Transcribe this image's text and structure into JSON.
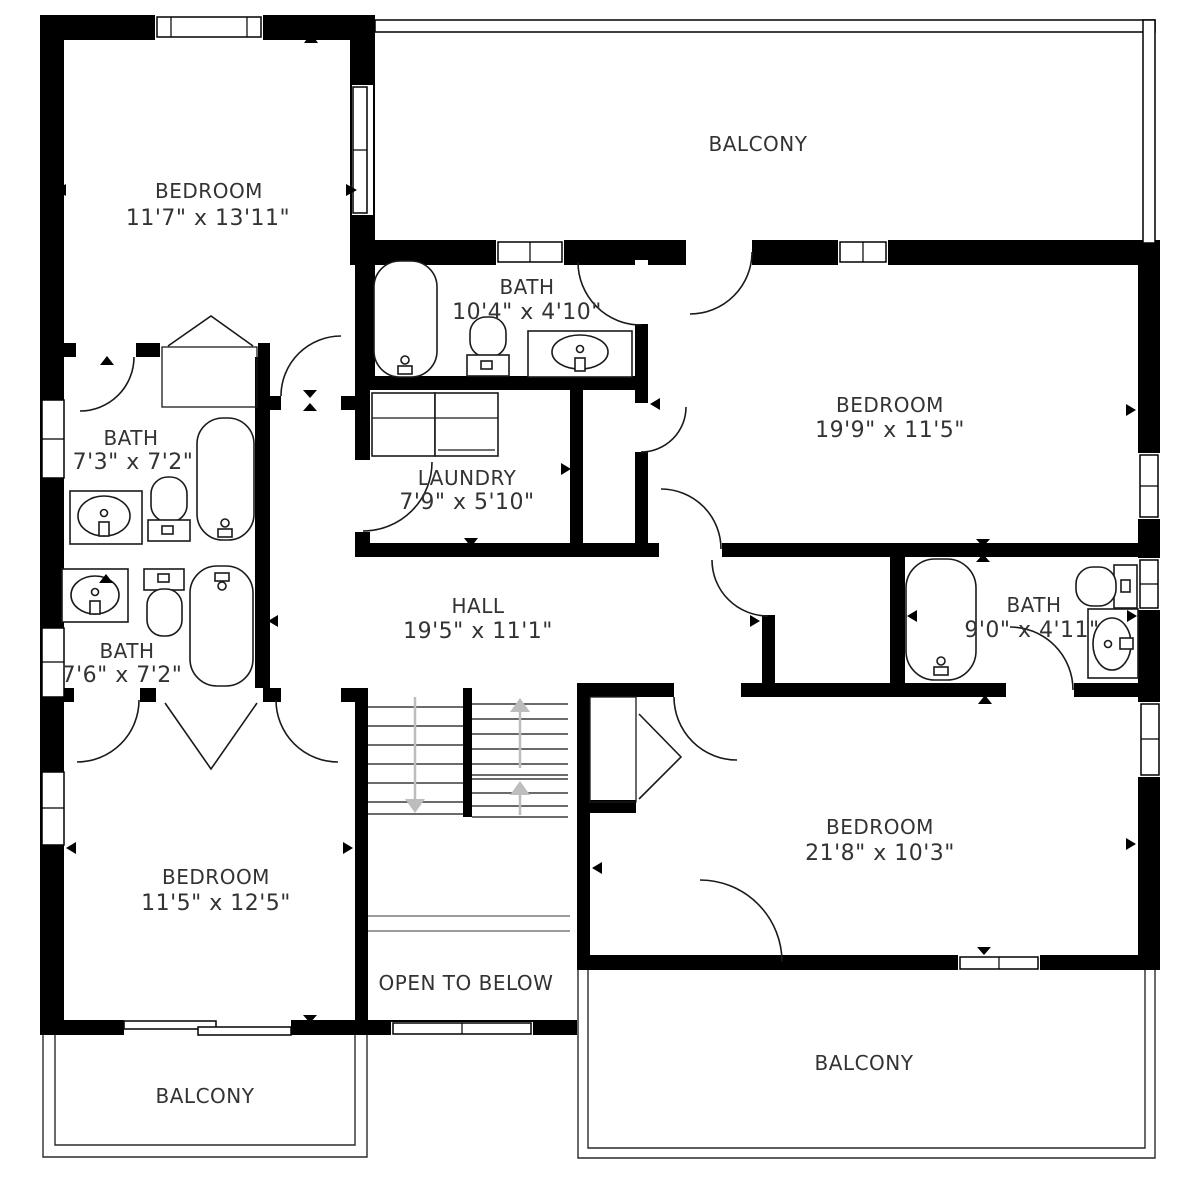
{
  "plan_title": "Second floor plan",
  "colors": {
    "wall": "#000000",
    "background": "#ffffff",
    "label_text": "#333333",
    "stair_arrow": "#bdbdbd"
  },
  "rooms": [
    {
      "id": "bedroom-top-left",
      "name": "BEDROOM",
      "dims": "11'7\" x 13'11\""
    },
    {
      "id": "balcony-top",
      "name": "BALCONY",
      "dims": ""
    },
    {
      "id": "bath-top",
      "name": "BATH",
      "dims": "10'4\" x 4'10\""
    },
    {
      "id": "bedroom-right",
      "name": "BEDROOM",
      "dims": "19'9\" x 11'5\""
    },
    {
      "id": "bath-upper-left",
      "name": "BATH",
      "dims": "7'3\" x 7'2\""
    },
    {
      "id": "laundry",
      "name": "LAUNDRY",
      "dims": "7'9\" x 5'10\""
    },
    {
      "id": "hall",
      "name": "HALL",
      "dims": "19'5\" x 11'1\""
    },
    {
      "id": "bath-right",
      "name": "BATH",
      "dims": "9'0\" x 4'11\""
    },
    {
      "id": "bath-lower-left",
      "name": "BATH",
      "dims": "7'6\" x 7'2\""
    },
    {
      "id": "bedroom-bottom-left",
      "name": "BEDROOM",
      "dims": "11'5\" x 12'5\""
    },
    {
      "id": "bedroom-bottom-right",
      "name": "BEDROOM",
      "dims": "21'8\" x 10'3\""
    },
    {
      "id": "open-to-below",
      "name": "OPEN TO BELOW",
      "dims": ""
    },
    {
      "id": "balcony-bottom-left",
      "name": "BALCONY",
      "dims": ""
    },
    {
      "id": "balcony-bottom-right",
      "name": "BALCONY",
      "dims": ""
    }
  ],
  "fixtures": [
    "bathtub x4",
    "toilet x4",
    "sink x4",
    "washer-dryer",
    "stairs-up",
    "stairs-down",
    "closet-bifold x3",
    "sliding-door",
    "windows",
    "door-swings"
  ]
}
